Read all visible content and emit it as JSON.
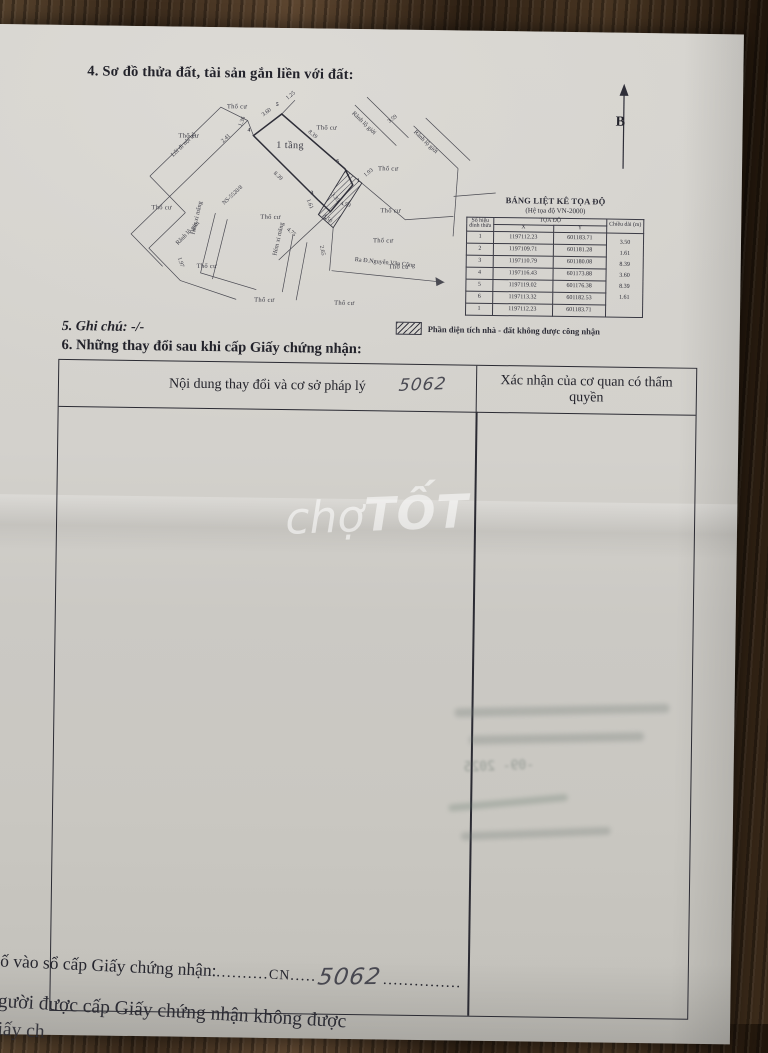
{
  "page": {
    "section4_title": "4. Sơ đồ thửa đất, tài sản gắn liền với đất:",
    "section5": "5. Ghi chú: -/-",
    "section6_title": "6. Những thay đổi sau khi cấp Giấy chứng nhận:"
  },
  "north": {
    "label": "B"
  },
  "diagram": {
    "labels": [
      {
        "t": "Thổ cư",
        "x": 98,
        "y": 10,
        "r": 0,
        "c": "topo"
      },
      {
        "t": "Thổ cư",
        "x": 188,
        "y": 30,
        "r": 0,
        "c": "topo"
      },
      {
        "t": "Thổ cư",
        "x": 50,
        "y": 40,
        "r": 0,
        "c": "topo"
      },
      {
        "t": "Thổ cư",
        "x": 24,
        "y": 112,
        "r": 0,
        "c": "topo"
      },
      {
        "t": "Thổ cư",
        "x": 133,
        "y": 120,
        "r": 0,
        "c": "topo"
      },
      {
        "t": "Thổ cư",
        "x": 250,
        "y": 70,
        "r": 0,
        "c": "topo"
      },
      {
        "t": "Thổ cư",
        "x": 253,
        "y": 112,
        "r": 0,
        "c": "topo"
      },
      {
        "t": "Thổ cư",
        "x": 246,
        "y": 142,
        "r": 0,
        "c": "topo"
      },
      {
        "t": "Thổ cư",
        "x": 70,
        "y": 170,
        "r": 0,
        "c": "topo"
      },
      {
        "t": "Thổ cư",
        "x": 128,
        "y": 203,
        "r": 0,
        "c": "topo"
      },
      {
        "t": "Thổ cư",
        "x": 208,
        "y": 205,
        "r": 0,
        "c": "topo"
      },
      {
        "t": "Thổ cư",
        "x": 262,
        "y": 168,
        "r": 0,
        "c": "topo"
      },
      {
        "t": "1 tầng",
        "x": 148,
        "y": 46,
        "r": 0,
        "c": "plot"
      },
      {
        "t": "NS-5520/8",
        "x": 96,
        "y": 108,
        "r": -44,
        "c": "meas"
      },
      {
        "t": "Lối đi nội bộ",
        "x": 44,
        "y": 60,
        "r": -45,
        "c": "road"
      },
      {
        "t": "Hẻm xi măng",
        "x": 66,
        "y": 138,
        "r": -78,
        "c": "road"
      },
      {
        "t": "Hẻm xi măng",
        "x": 148,
        "y": 158,
        "r": -78,
        "c": "road"
      },
      {
        "t": "Rãnh lộ giới",
        "x": 224,
        "y": 14,
        "r": 43,
        "c": "road"
      },
      {
        "t": "Rãnh lộ giới",
        "x": 286,
        "y": 32,
        "r": 43,
        "c": "road"
      },
      {
        "t": "Rãnh lộ giới",
        "x": 50,
        "y": 148,
        "r": -46,
        "c": "road"
      },
      {
        "t": "Ra Đ.Nguyễn Văn Công",
        "x": 228,
        "y": 161,
        "r": 5,
        "c": "road"
      },
      {
        "t": "1.25",
        "x": 158,
        "y": 2,
        "r": -40,
        "c": "meas"
      },
      {
        "t": "3.60",
        "x": 134,
        "y": 19,
        "r": -38,
        "c": "meas"
      },
      {
        "t": "1.36",
        "x": 112,
        "y": 30,
        "r": -70,
        "c": "meas"
      },
      {
        "t": "2.41",
        "x": 94,
        "y": 46,
        "r": -44,
        "c": "meas"
      },
      {
        "t": "8.39",
        "x": 180,
        "y": 34,
        "r": 40,
        "c": "meas"
      },
      {
        "t": "8.39",
        "x": 146,
        "y": 76,
        "r": 42,
        "c": "meas"
      },
      {
        "t": "3.59",
        "x": 260,
        "y": 24,
        "r": -38,
        "c": "meas"
      },
      {
        "t": "1.93",
        "x": 237,
        "y": 78,
        "r": -40,
        "c": "meas"
      },
      {
        "t": "3.35",
        "x": 204,
        "y": 96,
        "r": 50,
        "c": "meas"
      },
      {
        "t": "3.50",
        "x": 196,
        "y": 118,
        "r": 40,
        "c": "meas"
      },
      {
        "t": "1.61",
        "x": 180,
        "y": 102,
        "r": 68,
        "c": "meas"
      },
      {
        "t": "4.59",
        "x": 213,
        "y": 106,
        "r": 12,
        "c": "meas"
      },
      {
        "t": "4.75",
        "x": 160,
        "y": 132,
        "r": 40,
        "c": "meas"
      },
      {
        "t": "1.97",
        "x": 52,
        "y": 162,
        "r": 72,
        "c": "meas"
      },
      {
        "t": "2.65",
        "x": 194,
        "y": 148,
        "r": 78,
        "c": "meas"
      },
      {
        "t": "1",
        "x": 229,
        "y": 83,
        "r": 0,
        "c": "vx"
      },
      {
        "t": "2",
        "x": 196,
        "y": 120,
        "r": 0,
        "c": "vx"
      },
      {
        "t": "3",
        "x": 183,
        "y": 96,
        "r": 0,
        "c": "vx"
      },
      {
        "t": "4",
        "x": 119,
        "y": 34,
        "r": 0,
        "c": "vx"
      },
      {
        "t": "5",
        "x": 147,
        "y": 8,
        "r": 0,
        "c": "vx"
      },
      {
        "t": "6",
        "x": 208,
        "y": 64,
        "r": 0,
        "c": "vx"
      }
    ]
  },
  "coord_table": {
    "title": "BẢNG LIỆT KÊ TỌA ĐỘ",
    "subtitle": "(Hệ tọa độ VN-2000)",
    "col_vertex": "Số hiệu đỉnh thửa",
    "col_coords": "TỌA ĐỘ",
    "col_x": "X",
    "col_y": "Y",
    "col_length": "Chiều dài (m)",
    "rows": [
      {
        "no": "1",
        "x": "1197112.23",
        "y": "601183.71"
      },
      {
        "no": "2",
        "x": "1197109.71",
        "y": "601181.28"
      },
      {
        "no": "3",
        "x": "1197110.79",
        "y": "601180.08"
      },
      {
        "no": "4",
        "x": "1197116.43",
        "y": "601173.88"
      },
      {
        "no": "5",
        "x": "1197119.02",
        "y": "601176.38"
      },
      {
        "no": "6",
        "x": "1197113.32",
        "y": "601182.53"
      },
      {
        "no": "1",
        "x": "1197112.23",
        "y": "601183.71"
      }
    ],
    "lengths": [
      "3.50",
      "1.61",
      "8.39",
      "3.60",
      "8.39",
      "1.61"
    ]
  },
  "legend": {
    "text": "Phần diện tích nhà - đất không được công nhận"
  },
  "changes_table": {
    "col1": "Nội dung thay đổi và cơ sở pháp lý",
    "col2": "Xác nhận của cơ quan có thẩm quyền",
    "handwritten": "5062"
  },
  "watermark": {
    "part1": "chợ",
    "part2": "TỐT"
  },
  "bleed": {
    "date": "-09- 2025"
  },
  "footer": {
    "serial_label": "Số vào sổ cấp Giấy chứng nhận:",
    "dots1": "..........",
    "cn": "CN",
    "dots2": ".....",
    "number": "5062",
    "dots3": "...............",
    "note_line": "Người được cấp Giấy chứng nhận không được",
    "note_line2": "Giấy ch"
  }
}
